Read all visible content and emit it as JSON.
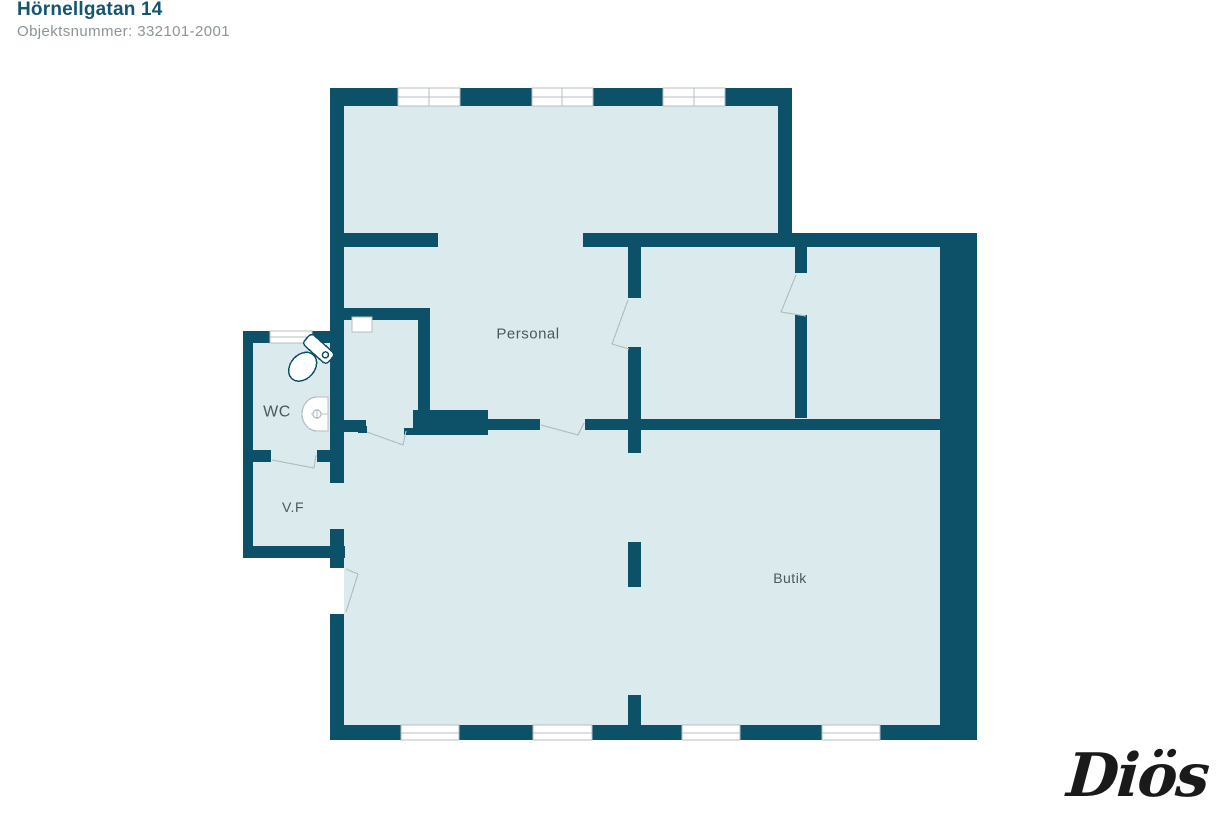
{
  "header": {
    "title": "Hörnellgatan 14",
    "subtitle": "Objektsnummer: 332101-2001"
  },
  "floorplan": {
    "rooms": [
      {
        "name": "Personal"
      },
      {
        "name": "WC"
      },
      {
        "name": "V.F"
      },
      {
        "name": "Butik"
      }
    ],
    "fixtures": [
      "toilet",
      "sink",
      "cabinet"
    ],
    "features": [
      "windows",
      "door-swings",
      "pillar"
    ]
  },
  "logo": {
    "text": "Diös"
  },
  "colors": {
    "wall": "#0d5168",
    "floor": "#dbebed",
    "frame_line": "#b4bfc1",
    "room_label": "#4a575f",
    "title": "#14566e",
    "subtitle": "#8b9599",
    "logo": "#1a1a1a"
  }
}
